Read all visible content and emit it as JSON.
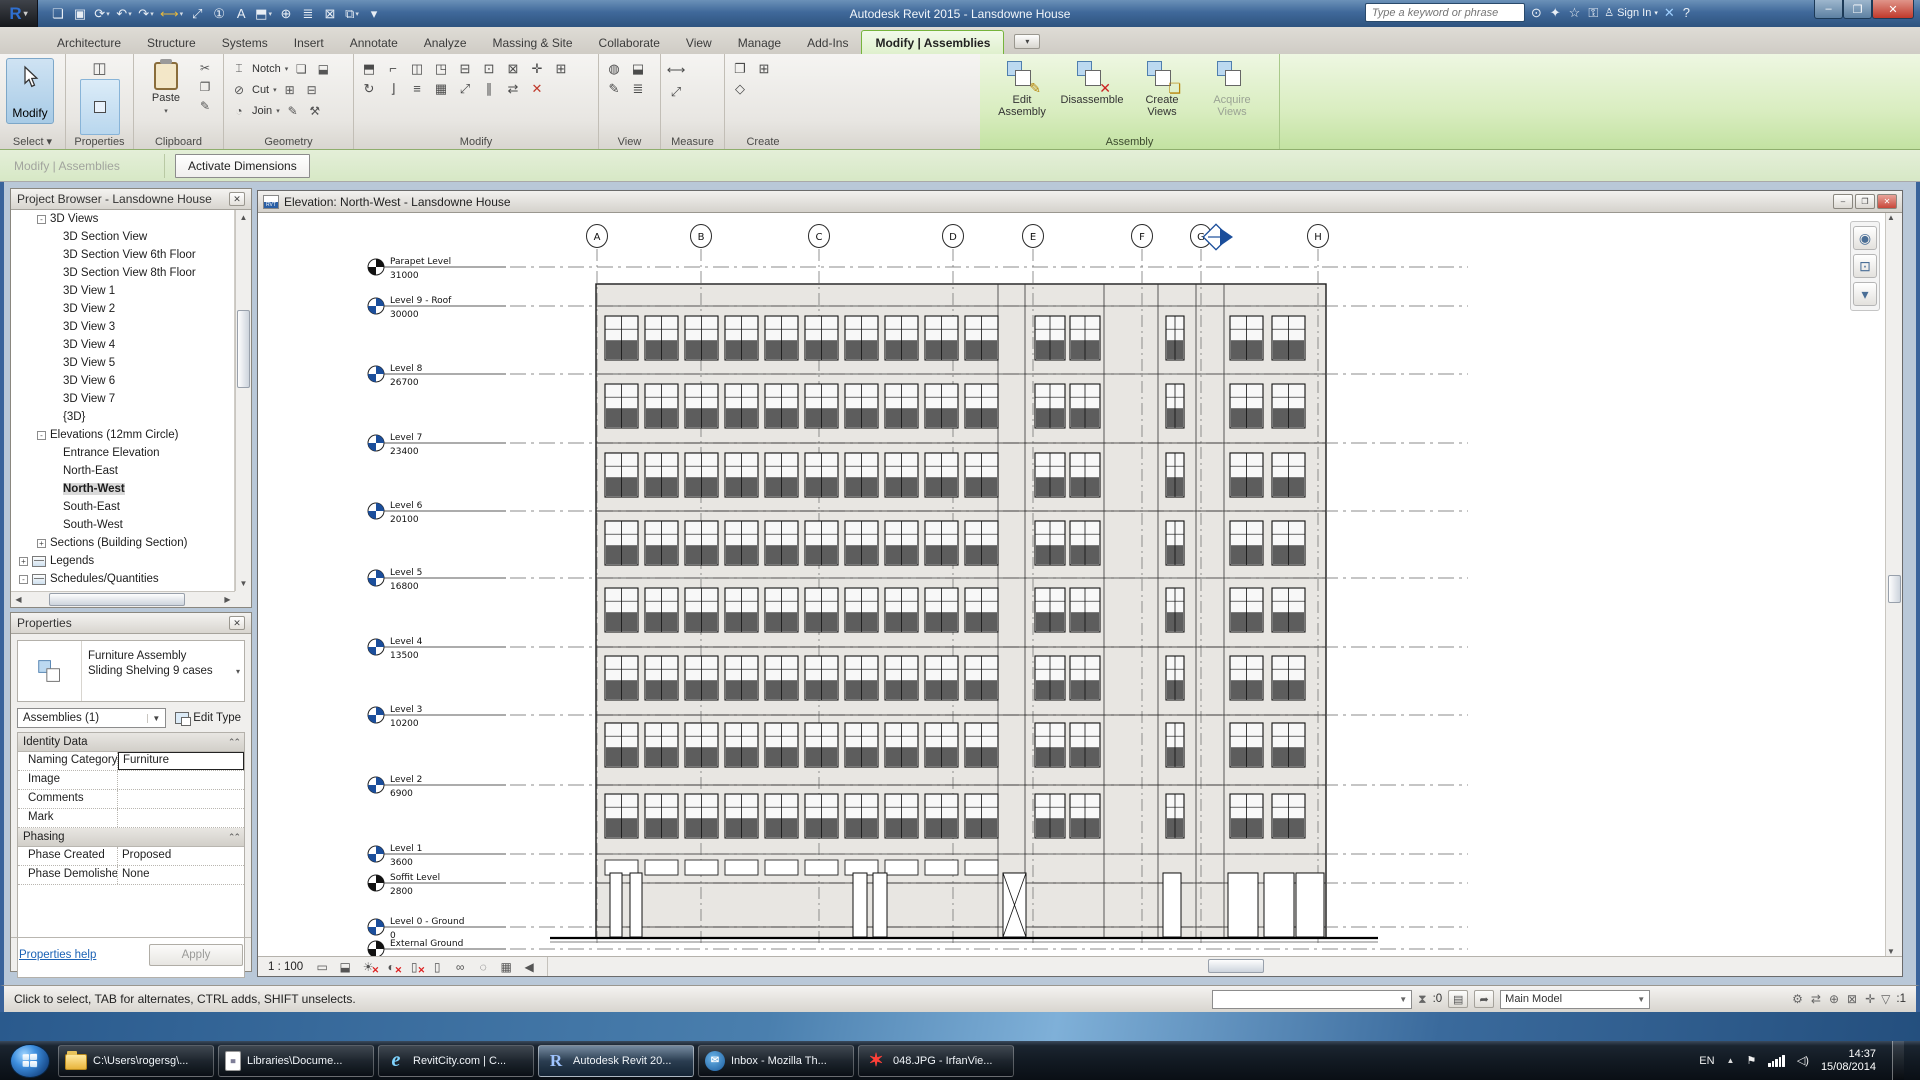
{
  "titlebar": {
    "app_title": "Autodesk Revit 2015  -  Lansdowne House",
    "logo_letter": "R",
    "search_placeholder": "Type a keyword or phrase",
    "sign_in_label": "Sign In",
    "qat": [
      {
        "name": "open-icon",
        "g": "❏"
      },
      {
        "name": "save-icon",
        "g": "▣"
      },
      {
        "name": "sync-with-central-icon",
        "g": "⟳",
        "dd": true
      },
      {
        "name": "undo-icon",
        "g": "↶",
        "dd": true
      },
      {
        "name": "redo-icon",
        "g": "↷",
        "dd": true
      },
      {
        "name": "measure-icon",
        "g": "⟷",
        "dd": true,
        "cls": "gold"
      },
      {
        "name": "aligned-dimension-icon",
        "g": "⤢"
      },
      {
        "name": "tag-by-category-icon",
        "g": "①"
      },
      {
        "name": "text-icon",
        "g": "A"
      },
      {
        "name": "default-3d-view-icon",
        "g": "⬒",
        "dd": true
      },
      {
        "name": "section-icon",
        "g": "⊕"
      },
      {
        "name": "thin-lines-icon",
        "g": "≣"
      },
      {
        "name": "close-hidden-windows-icon",
        "g": "⊠"
      },
      {
        "name": "switch-windows-icon",
        "g": "⧉",
        "dd": true
      },
      {
        "name": "customize-qat-icon",
        "g": "▾"
      }
    ],
    "infocenter_icons": [
      {
        "name": "search-icon",
        "g": "⊙"
      },
      {
        "name": "communication-center-icon",
        "g": "✦"
      },
      {
        "name": "favorites-icon",
        "g": "☆"
      },
      {
        "name": "key-icon",
        "g": "⚿"
      }
    ],
    "after_signin_icons": [
      {
        "name": "exchange-apps-icon",
        "g": "✕",
        "cls": "blue"
      },
      {
        "name": "help-icon",
        "g": "?"
      }
    ],
    "window_buttons": [
      {
        "name": "minimize-button",
        "g": "–"
      },
      {
        "name": "maximize-button",
        "g": "❐"
      },
      {
        "name": "close-button",
        "g": "✕",
        "cls": "close"
      }
    ]
  },
  "ribbon": {
    "tabs": [
      {
        "label": "Architecture"
      },
      {
        "label": "Structure"
      },
      {
        "label": "Systems"
      },
      {
        "label": "Insert"
      },
      {
        "label": "Annotate"
      },
      {
        "label": "Analyze"
      },
      {
        "label": "Massing & Site"
      },
      {
        "label": "Collaborate"
      },
      {
        "label": "View"
      },
      {
        "label": "Manage"
      },
      {
        "label": "Add-Ins"
      }
    ],
    "active_tab": "Modify | Assemblies",
    "select": {
      "big_label": "Modify",
      "panel": "Select"
    },
    "properties": {
      "panel": "Properties"
    },
    "clipboard": {
      "paste_label": "Paste",
      "panel": "Clipboard",
      "small": [
        {
          "name": "cut-icon",
          "g": "✂"
        },
        {
          "name": "copy-icon",
          "g": "❐"
        },
        {
          "name": "match-type-icon",
          "g": "✎"
        }
      ]
    },
    "geometry": {
      "panel": "Geometry",
      "rows": [
        {
          "name": "notch-icon",
          "g": "⌶",
          "label": "Notch",
          "t1": "❏",
          "t2": "⬓"
        },
        {
          "name": "cut-geometry-icon",
          "g": "⊘",
          "label": "Cut",
          "t1": "⊞",
          "t2": "⊟"
        },
        {
          "name": "join-geometry-icon",
          "g": "◔",
          "label": "Join",
          "t1": "✎",
          "t2": "⚒"
        }
      ]
    },
    "modify": {
      "panel": "Modify",
      "icons": [
        {
          "name": "wall-modify-icon",
          "g": "⬒"
        },
        {
          "name": "cope-icon",
          "g": "⌐"
        },
        {
          "name": "mirror-pick-icon",
          "g": "◫"
        },
        {
          "name": "mirror-axis-icon",
          "g": "◳"
        },
        {
          "name": "split-icon",
          "g": "⊟"
        },
        {
          "name": "pin-icon",
          "g": "⊡"
        },
        {
          "name": "unpin-icon",
          "g": "⊠"
        },
        {
          "name": "move-icon",
          "g": "✛"
        },
        {
          "name": "copy-icon",
          "g": "⊞"
        },
        {
          "name": "rotate-icon",
          "g": "↻"
        },
        {
          "name": "trim-icon",
          "g": "⌋"
        },
        {
          "name": "offset-icon",
          "g": "≡"
        },
        {
          "name": "array-icon",
          "g": "▦"
        },
        {
          "name": "scale-icon",
          "g": "⤢"
        },
        {
          "name": "align-icon",
          "g": "∥"
        },
        {
          "name": "swap-icon",
          "g": "⇄"
        },
        {
          "name": "delete-icon",
          "g": "✕",
          "cls": "red"
        }
      ]
    },
    "view": {
      "panel": "View",
      "icons": [
        {
          "name": "reveal-hidden-icon",
          "g": "◍"
        },
        {
          "name": "cutaway-icon",
          "g": "⬓"
        },
        {
          "name": "linework-icon",
          "g": "✎"
        },
        {
          "name": "override-graphics-icon",
          "g": "≣"
        }
      ]
    },
    "measure": {
      "panel": "Measure",
      "icons": [
        {
          "name": "measure-length-icon",
          "g": "⟷",
          "cls": "gold"
        },
        {
          "name": "measure-angle-icon",
          "g": "⤢"
        }
      ]
    },
    "create": {
      "panel": "Create",
      "icons": [
        {
          "name": "create-part-icon",
          "g": "❐"
        },
        {
          "name": "create-group-icon",
          "g": "⊞"
        },
        {
          "name": "create-similar-icon",
          "g": "◇"
        }
      ]
    },
    "assembly": {
      "panel": "Assembly",
      "buttons": [
        {
          "name": "edit-assembly-button",
          "label": "Edit Assembly",
          "ov": "✎",
          "ovcls": ""
        },
        {
          "name": "disassemble-button",
          "label": "Disassemble",
          "ov": "✕",
          "ovcls": "red"
        },
        {
          "name": "create-views-button",
          "label": "Create Views",
          "ov": "❏",
          "ovcls": ""
        },
        {
          "name": "acquire-views-button",
          "label": "Acquire Views",
          "ov": "",
          "ovcls": "",
          "disabled": true
        }
      ]
    }
  },
  "options_bar": {
    "context_label": "Modify | Assemblies",
    "activate_dimensions": "Activate Dimensions"
  },
  "project_browser": {
    "title": "Project Browser - Lansdowne House",
    "items": [
      {
        "label": "3D Views",
        "pm": "-",
        "pad": 26
      },
      {
        "label": "3D Section View",
        "pad": 52
      },
      {
        "label": "3D Section View 6th Floor",
        "pad": 52
      },
      {
        "label": "3D Section View 8th Floor",
        "pad": 52
      },
      {
        "label": "3D View 1",
        "pad": 52
      },
      {
        "label": "3D View 2",
        "pad": 52
      },
      {
        "label": "3D View 3",
        "pad": 52
      },
      {
        "label": "3D View 4",
        "pad": 52
      },
      {
        "label": "3D View 5",
        "pad": 52
      },
      {
        "label": "3D View 6",
        "pad": 52
      },
      {
        "label": "3D View 7",
        "pad": 52
      },
      {
        "label": "{3D}",
        "pad": 52
      },
      {
        "label": "Elevations (12mm Circle)",
        "pm": "-",
        "pad": 26
      },
      {
        "label": "Entrance Elevation",
        "pad": 52
      },
      {
        "label": "North-East",
        "pad": 52
      },
      {
        "label": "North-West",
        "pad": 52,
        "cls": "sel"
      },
      {
        "label": "South-East",
        "pad": 52
      },
      {
        "label": "South-West",
        "pad": 52
      },
      {
        "label": "Sections (Building Section)",
        "pm": "+",
        "pad": 26
      },
      {
        "label": "Legends",
        "pm": "+",
        "pad": 8,
        "icon": true
      },
      {
        "label": "Schedules/Quantities",
        "pm": "-",
        "pad": 8,
        "icon": true
      }
    ]
  },
  "properties": {
    "title": "Properties",
    "type_line1": "Furniture Assembly",
    "type_line2": "Sliding Shelving 9 cases",
    "combo_value": "Assemblies (1)",
    "edit_type_label": "Edit Type",
    "identity_header": "Identity Data",
    "identity_rows": [
      {
        "label": "Naming Category",
        "value": "Furniture",
        "edit": true
      },
      {
        "label": "Image",
        "value": ""
      },
      {
        "label": "Comments",
        "value": ""
      },
      {
        "label": "Mark",
        "value": ""
      }
    ],
    "phasing_header": "Phasing",
    "phasing_rows": [
      {
        "label": "Phase Created",
        "value": "Proposed"
      },
      {
        "label": "Phase Demolished",
        "value": "None"
      }
    ],
    "help_label": "Properties help",
    "apply_label": "Apply"
  },
  "drawing": {
    "view_title": "Elevation: North-West - Lansdowne House",
    "scale_label": "1 : 100",
    "viewbar_icons": [
      {
        "name": "visual-style-icon",
        "g": "▭"
      },
      {
        "name": "shaded-view-icon",
        "g": "⬓"
      },
      {
        "name": "sun-path-off-icon",
        "g": "☀",
        "x": true
      },
      {
        "name": "shadows-off-icon",
        "g": "◐",
        "x": true
      },
      {
        "name": "crop-view-off-icon",
        "g": "▯",
        "x": true
      },
      {
        "name": "show-crop-region-icon",
        "g": "▯"
      },
      {
        "name": "temporary-hide-isolate-icon",
        "g": "∞"
      },
      {
        "name": "reveal-hidden-elements-icon",
        "g": "◌"
      },
      {
        "name": "analytical-model-icon",
        "g": "▦"
      },
      {
        "name": "reveal-constraints-icon",
        "g": "◀"
      }
    ],
    "nav_icons": [
      {
        "name": "steering-wheel-icon",
        "g": "◉"
      },
      {
        "name": "zoom-region-icon",
        "g": "⊡"
      },
      {
        "name": "nav-collapse-icon",
        "g": "▾"
      }
    ],
    "grids": [
      {
        "label": "A",
        "x": 339
      },
      {
        "label": "B",
        "x": 443
      },
      {
        "label": "C",
        "x": 561
      },
      {
        "label": "D",
        "x": 695
      },
      {
        "label": "E",
        "x": 775
      },
      {
        "label": "F",
        "x": 884
      },
      {
        "label": "G",
        "x": 943
      },
      {
        "label": "H",
        "x": 1060
      }
    ],
    "levels": [
      {
        "name": "Parapet Level",
        "elev": "31000",
        "y": 54,
        "color": "#111"
      },
      {
        "name": "Level 9 - Roof",
        "elev": "30000",
        "y": 93,
        "color": "#1b4e9b"
      },
      {
        "name": "Level 8",
        "elev": "26700",
        "y": 161,
        "color": "#1b4e9b"
      },
      {
        "name": "Level 7",
        "elev": "23400",
        "y": 230,
        "color": "#1b4e9b"
      },
      {
        "name": "Level 6",
        "elev": "20100",
        "y": 298,
        "color": "#1b4e9b"
      },
      {
        "name": "Level 5",
        "elev": "16800",
        "y": 365,
        "color": "#1b4e9b"
      },
      {
        "name": "Level 4",
        "elev": "13500",
        "y": 434,
        "color": "#1b4e9b"
      },
      {
        "name": "Level 3",
        "elev": "10200",
        "y": 502,
        "color": "#1b4e9b"
      },
      {
        "name": "Level 2",
        "elev": "6900",
        "y": 572,
        "color": "#1b4e9b"
      },
      {
        "name": "Level 1",
        "elev": "3600",
        "y": 641,
        "color": "#1b4e9b"
      },
      {
        "name": "Soffit Level",
        "elev": "2800",
        "y": 670,
        "color": "#111"
      },
      {
        "name": "Level 0 - Ground",
        "elev": "0",
        "y": 714,
        "color": "#1b4e9b"
      },
      {
        "name": "External Ground",
        "elev": "",
        "y": 736,
        "color": "#111"
      }
    ],
    "building": {
      "left": 338,
      "right": 1068,
      "top": 71,
      "bottom": 725,
      "window_h": 44,
      "floor_tops": [
        103,
        171,
        240,
        308,
        375,
        443,
        510,
        581
      ],
      "dividers": [
        740,
        767,
        846,
        900,
        938,
        966
      ],
      "sections": [
        {
          "w": 33,
          "cols": [
            347,
            387,
            427,
            467,
            507,
            547,
            587,
            627,
            667,
            707
          ]
        },
        {
          "w": 30,
          "cols": [
            777,
            812
          ]
        },
        {
          "w": 18,
          "cols": [
            908
          ]
        },
        {
          "w": 33,
          "cols": [
            972,
            1014
          ]
        }
      ],
      "ground": [
        {
          "x": 352,
          "w": 12
        },
        {
          "x": 372,
          "w": 12
        },
        {
          "x": 595,
          "w": 14
        },
        {
          "x": 615,
          "w": 14
        },
        {
          "x": 745,
          "w": 23,
          "brace": true
        },
        {
          "x": 905,
          "w": 18
        },
        {
          "x": 970,
          "w": 30
        },
        {
          "x": 1006,
          "w": 30
        },
        {
          "x": 1038,
          "w": 28
        }
      ],
      "elev_marker": {
        "x": 958,
        "y": 24
      }
    }
  },
  "status_bar": {
    "hint": "Click to select, TAB for alternates, CTRL adds, SHIFT unselects.",
    "worksets_count": ":0",
    "main_model": "Main Model",
    "filter_count": ":1",
    "left_icons": [
      {
        "name": "worksets-icon",
        "g": "⛆"
      },
      {
        "name": "design-options-icon",
        "g": "▤"
      },
      {
        "name": "active-only-icon",
        "g": "➦"
      }
    ],
    "right_icons": [
      {
        "name": "worksharing-display-icon",
        "g": "⚙"
      },
      {
        "name": "editing-requests-icon",
        "g": "⇄"
      },
      {
        "name": "pin-status-icon",
        "g": "⊕"
      },
      {
        "name": "exclude-options-icon",
        "g": "⊠"
      },
      {
        "name": "press-drag-icon",
        "g": "✛"
      }
    ]
  },
  "taskbar": {
    "buttons": [
      {
        "name": "taskbar-explorer-button",
        "label": "C:\\Users\\rogersg\\...",
        "icon": "folder",
        "iglyph": ""
      },
      {
        "name": "taskbar-libraries-button",
        "label": "Libraries\\Docume...",
        "icon": "doc",
        "iglyph": "≣"
      },
      {
        "name": "taskbar-ie-button",
        "label": "RevitCity.com | C...",
        "icon": "e",
        "iglyph": "e"
      },
      {
        "name": "taskbar-revit-button",
        "label": "Autodesk Revit 20...",
        "icon": "r",
        "iglyph": "R",
        "active": true
      },
      {
        "name": "taskbar-thunderbird-button",
        "label": "Inbox - Mozilla Th...",
        "icon": "tb",
        "iglyph": "✉"
      },
      {
        "name": "taskbar-irfanview-button",
        "label": "048.JPG - IrfanVie...",
        "icon": "iv",
        "iglyph": "✶"
      }
    ],
    "tray": {
      "lang": "EN",
      "time": "14:37",
      "date": "15/08/2014"
    }
  }
}
